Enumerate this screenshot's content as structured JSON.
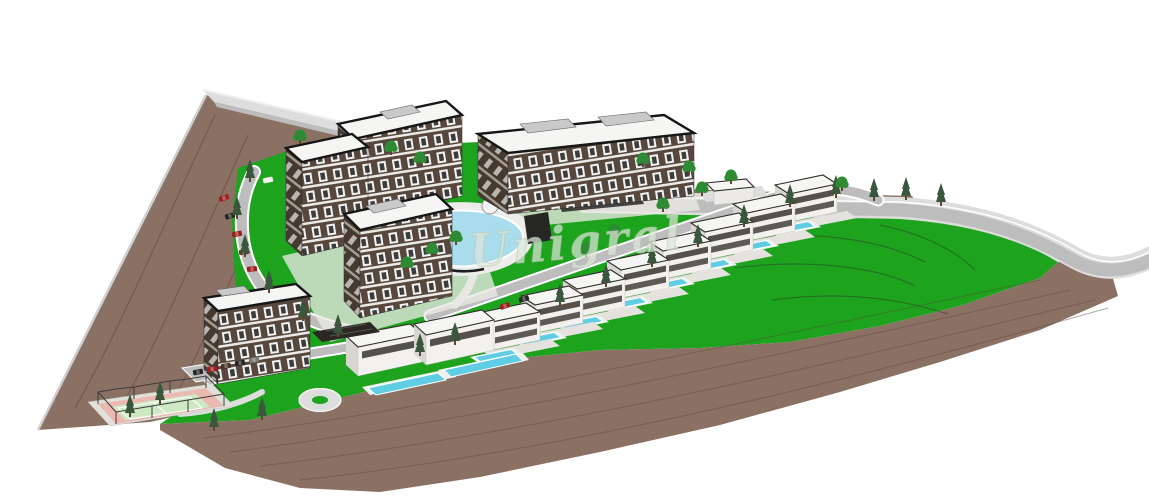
{
  "canvas": {
    "width_px": 1149,
    "height_px": 500
  },
  "watermark": {
    "text": "Unigral",
    "style": "cursive-italic"
  },
  "palette": {
    "background": "#ffffff",
    "grass": "#1da31d",
    "dirt": "#8a7164",
    "dirt_line": "#5c4a3c",
    "road": "#bdbdbd",
    "road_light": "#dddddd",
    "roof": "#f5f5f3",
    "roof_edge": "#161616",
    "facade": "#57473d",
    "facade_side": "#453930",
    "window": "#f2f2f2",
    "glass": "#3c3c3c",
    "lagoon_pool": "#a9dcec",
    "villa_pool": "#5fcde4",
    "tree_dark": "#3a573d",
    "tree_leaf": "#2e8b33",
    "trunk": "#5f462f",
    "car_red": "#9e1f1f",
    "car_dark": "#242424",
    "tennis_border": "#ecb9b1",
    "tennis_court": "#cfe8c4",
    "fence": "#3b3b3b",
    "contour": "#4a3a2c",
    "watermark_fill": "#dce6d8"
  },
  "scene": {
    "type": "3d-architectural-site-plan-render",
    "view": "aerial-isometric",
    "site_shape": "triangular",
    "apartment_blocks": 5,
    "row_villas_with_pools": 8,
    "modern_flat_roof_villas": 2,
    "lagoon_pools": 1,
    "tennis_courts": 1,
    "surroundings": "excavated-brown-terrain"
  }
}
